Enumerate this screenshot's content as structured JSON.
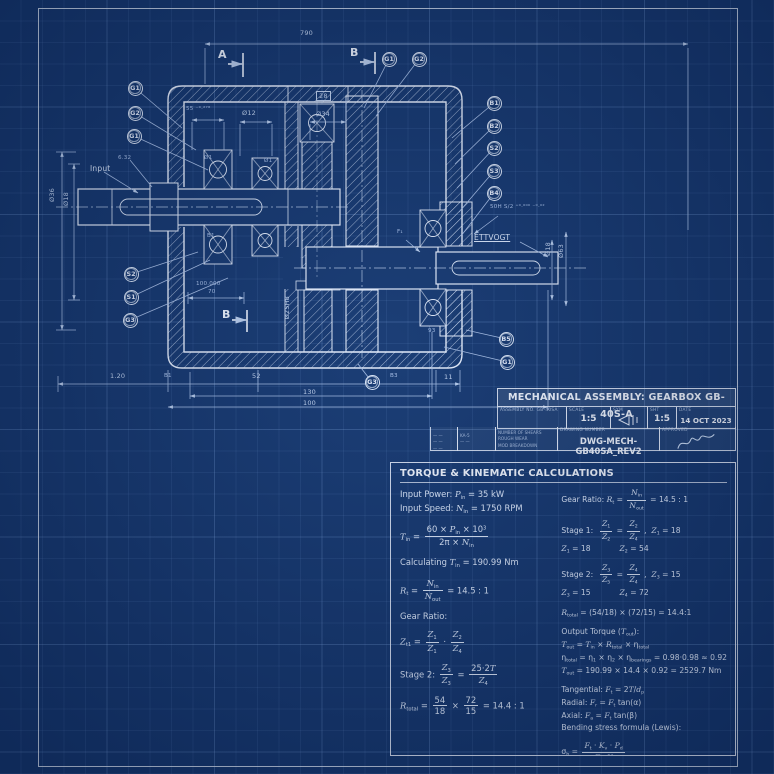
{
  "page": {
    "colors": {
      "background": "#15376e",
      "line": "#e9f0fc",
      "dim_line": "#a9c0e6",
      "dim_text": "#c4d5ef",
      "grid": "#2a5193"
    }
  },
  "drawing": {
    "balloons": [
      {
        "label": "G1",
        "x": 135,
        "y": 88,
        "lx": 182,
        "ly": 128
      },
      {
        "label": "G2",
        "x": 135,
        "y": 113,
        "lx": 196,
        "ly": 150
      },
      {
        "label": "G1",
        "x": 134,
        "y": 136,
        "lx": 208,
        "ly": 170
      },
      {
        "label": "S2",
        "x": 131,
        "y": 274,
        "lx": 198,
        "ly": 252
      },
      {
        "label": "S1",
        "x": 131,
        "y": 297,
        "lx": 210,
        "ly": 260
      },
      {
        "label": "G3",
        "x": 130,
        "y": 320,
        "lx": 228,
        "ly": 278
      },
      {
        "label": "G1",
        "x": 389,
        "y": 59,
        "lx": 364,
        "ly": 108
      },
      {
        "label": "G2",
        "x": 419,
        "y": 59,
        "lx": 376,
        "ly": 116
      },
      {
        "label": "B1",
        "x": 494,
        "y": 103,
        "lx": 452,
        "ly": 138
      },
      {
        "label": "B2",
        "x": 494,
        "y": 126,
        "lx": 455,
        "ly": 164
      },
      {
        "label": "S2",
        "x": 494,
        "y": 148,
        "lx": 457,
        "ly": 188
      },
      {
        "label": "S3",
        "x": 494,
        "y": 171,
        "lx": 459,
        "ly": 212
      },
      {
        "label": "B4",
        "x": 494,
        "y": 193,
        "lx": 461,
        "ly": 236
      },
      {
        "label": "B5",
        "x": 506,
        "y": 339,
        "lx": 466,
        "ly": 330
      },
      {
        "label": "G1",
        "x": 507,
        "y": 362,
        "lx": 444,
        "ly": 347
      },
      {
        "label": "G3",
        "x": 372,
        "y": 382,
        "lx": 358,
        "ly": 364
      }
    ],
    "labels": [
      {
        "t": "790",
        "x": 300,
        "y": 29
      },
      {
        "t": "A",
        "x": 218,
        "y": 48,
        "c": "sec"
      },
      {
        "t": "B",
        "x": 350,
        "y": 46,
        "c": "sec"
      },
      {
        "t": "B",
        "x": 222,
        "y": 308,
        "c": "sec"
      },
      {
        "t": "28",
        "x": 316,
        "y": 91,
        "c": "box"
      },
      {
        "t": "Ø12",
        "x": 242,
        "y": 109
      },
      {
        "t": "Ø34",
        "x": 316,
        "y": 110
      },
      {
        "t": "55 ⁻⁰·²⁷⁸",
        "x": 186,
        "y": 106,
        "c": "sm"
      },
      {
        "t": "Input",
        "x": 90,
        "y": 164,
        "c": "lbl"
      },
      {
        "t": "6.32",
        "x": 118,
        "y": 155,
        "c": "sm"
      },
      {
        "t": "Ø36",
        "x": 48,
        "y": 188,
        "r": 1
      },
      {
        "t": "Ø18",
        "x": 62,
        "y": 192,
        "r": 1
      },
      {
        "t": "100.000",
        "x": 196,
        "y": 281,
        "c": "sm"
      },
      {
        "t": "70",
        "x": 208,
        "y": 289,
        "c": "sm"
      },
      {
        "t": "Ø25H8",
        "x": 283,
        "y": 296,
        "r": 1
      },
      {
        "t": "1.20",
        "x": 110,
        "y": 372
      },
      {
        "t": "B1",
        "x": 164,
        "y": 373,
        "c": "sm"
      },
      {
        "t": "52",
        "x": 252,
        "y": 372
      },
      {
        "t": "B3",
        "x": 390,
        "y": 373,
        "c": "sm"
      },
      {
        "t": "11",
        "x": 444,
        "y": 373
      },
      {
        "t": "130",
        "x": 303,
        "y": 388
      },
      {
        "t": "100",
        "x": 303,
        "y": 399
      },
      {
        "t": "50H S/2 ⁺⁰·⁰⁰⁰ ⁻⁰·⁰²",
        "x": 490,
        "y": 204,
        "c": "sm"
      },
      {
        "t": "ETTVOGT",
        "x": 474,
        "y": 233,
        "c": "lbl u"
      },
      {
        "t": "Ø18",
        "x": 544,
        "y": 242,
        "r": 1
      },
      {
        "t": "Ø63",
        "x": 557,
        "y": 244,
        "r": 1
      },
      {
        "t": "93",
        "x": 428,
        "y": 328,
        "c": "sm"
      },
      {
        "t": "F₁",
        "x": 397,
        "y": 229,
        "c": "sm"
      },
      {
        "t": "Ø1",
        "x": 204,
        "y": 155,
        "c": "sm"
      },
      {
        "t": "Ø1",
        "x": 264,
        "y": 158,
        "c": "sm"
      },
      {
        "t": "B1",
        "x": 207,
        "y": 233,
        "c": "sm"
      }
    ]
  },
  "title_block": {
    "title": "MECHANICAL ASSEMBLY: GEARBOX GB-40S-A",
    "assembly_no": "ASSEMBLY NO. GB-40SA",
    "scale_label": "SCALE",
    "scale_value": "1:5",
    "sym_label": "SYM",
    "sht_label": "SHT",
    "sht_value": "1:5",
    "date_label": "DATE",
    "date_value": "14 OCT 2023",
    "ext1": "— —<br>— —<br>— —",
    "ext2": "KA-5<br>— —",
    "sheets": "NUMBER OF SHEARS<br>ROUGH WEAR<br>MOD BREAKDOWN",
    "dwg_label": "DRAWING NUMBER",
    "dwg_value": "DWG-MECH-GB40SA_REV2",
    "approved_label": "APPROVED"
  },
  "calc": {
    "title": "TORQUE & KINEMATIC CALCULATIONS",
    "left": [
      "Input Power: <i>P</i><sub>in</sub> = 35 kW<br>Input Speed: <i>N</i><sub>in</sub> = 1750 RPM",
      "<i>T</i><sub>in</sub> = <span class='frac'><span>60 × <i>P</i><sub>in</sub> × 10<sup>3</sup></span><span>2π × <i>N</i><sub>in</sub></span></span>",
      "Calculating <i>T</i><sub>in</sub> = 190.99 Nm",
      "<i>R</i><sub>t</sub> = <span class='frac'><span><i>N</i><sub>in</sub></span><span><i>N</i><sub>out</sub></span></span> = 14.5 : 1",
      "Gear Ratio:",
      "<i>Z</i><sub>t1</sub> = <span class='frac'><span><i>Z</i><sub>1</sub></span><span><i>Z</i><sub>1</sub></span></span> · <span class='frac'><span><i>Z</i><sub>2</sub></span><span><i>Z</i><sub>4</sub></span></span>",
      "Stage 2: <span class='frac'><span><i>Z</i><sub>3</sub></span><span><i>Z</i><sub>3</sub></span></span> = <span class='frac'><span>25·2<i>T</i></span><span><i>Z</i><sub>4</sub></span></span>",
      "<i>R</i><sub>total</sub> = <span class='frac'><span>54</span><span>18</span></span> × <span class='frac'><span>72</span><span>15</span></span> = 14.4 : 1"
    ],
    "right": [
      "Gear Ratio: <i>R</i><sub>t</sub> = <span class='frac'><span><i>N</i><sub>in</sub></span><span><i>N</i><sub>out</sub></span></span> = 14.5 : 1",
      "Stage 1:&nbsp;&nbsp;<span class='frac'><span><i>Z</i><sub>1</sub></span><span><i>Z</i><sub>2</sub></span></span> = <span class='frac'><span><i>Z</i><sub>2</sub></span><span><i>Z</i><sub>4</sub></span></span> ,&nbsp;&nbsp;<i>Z</i><sub>1</sub> = 18<br><i>Z</i><sub>1</sub> = 18&nbsp;&nbsp;&nbsp;&nbsp;&nbsp;&nbsp;&nbsp;&nbsp;&nbsp;&nbsp;&nbsp;&nbsp;<i>Z</i><sub>2</sub> = 54",
      "Stage 2:&nbsp;&nbsp;<span class='frac'><span><i>Z</i><sub>3</sub></span><span><i>Z</i><sub>5</sub></span></span> = <span class='frac'><span><i>Z</i><sub>4</sub></span><span><i>Z</i><sub>4</sub></span></span> ,&nbsp;&nbsp;<i>Z</i><sub>3</sub> = 15<br><i>Z</i><sub>3</sub> = 15&nbsp;&nbsp;&nbsp;&nbsp;&nbsp;&nbsp;&nbsp;&nbsp;&nbsp;&nbsp;&nbsp;&nbsp;<i>Z</i><sub>4</sub> = 72",
      "<i>R</i><sub>total</sub> = (54/18) × (72/15) = 14.4:1",
      "Output Torque (<i>T</i><sub>out</sub>):<br><i>T</i><sub>out</sub> = <i>T</i><sub>in</sub> × <i>R</i><sub>total</sub> × η<sub>total</sub><br>η<sub>total</sub> = η<sub>1</sub> × η<sub>2</sub> × η<sub>bearings</sub> = 0.98·0.98 ≈ 0.92<br><i>T</i><sub>out</sub> = 190.99 × 14.4 × 0.92 = 2529.7 Nm",
      "Tangential: <i>F</i><sub>t</sub> = 2<i>T</i>/<i>d</i><sub>p</sub><br>Radial: <i>F</i><sub>r</sub> = <i>F</i><sub>t</sub> tan(α)<br>Axial: <i>F</i><sub>a</sub> = <i>F</i><sub>t</sub> tan(β)<br>Bending stress formula (Lewis):",
      "σ<sub>b</sub> = <span class='frac'><span><i>F</i><sub>t</sub> · <i>K</i><sub>v</sub> · <i>P</i><sub>d</sub></span><span><i>F</i> · <i>Y</i></span></span>"
    ]
  }
}
